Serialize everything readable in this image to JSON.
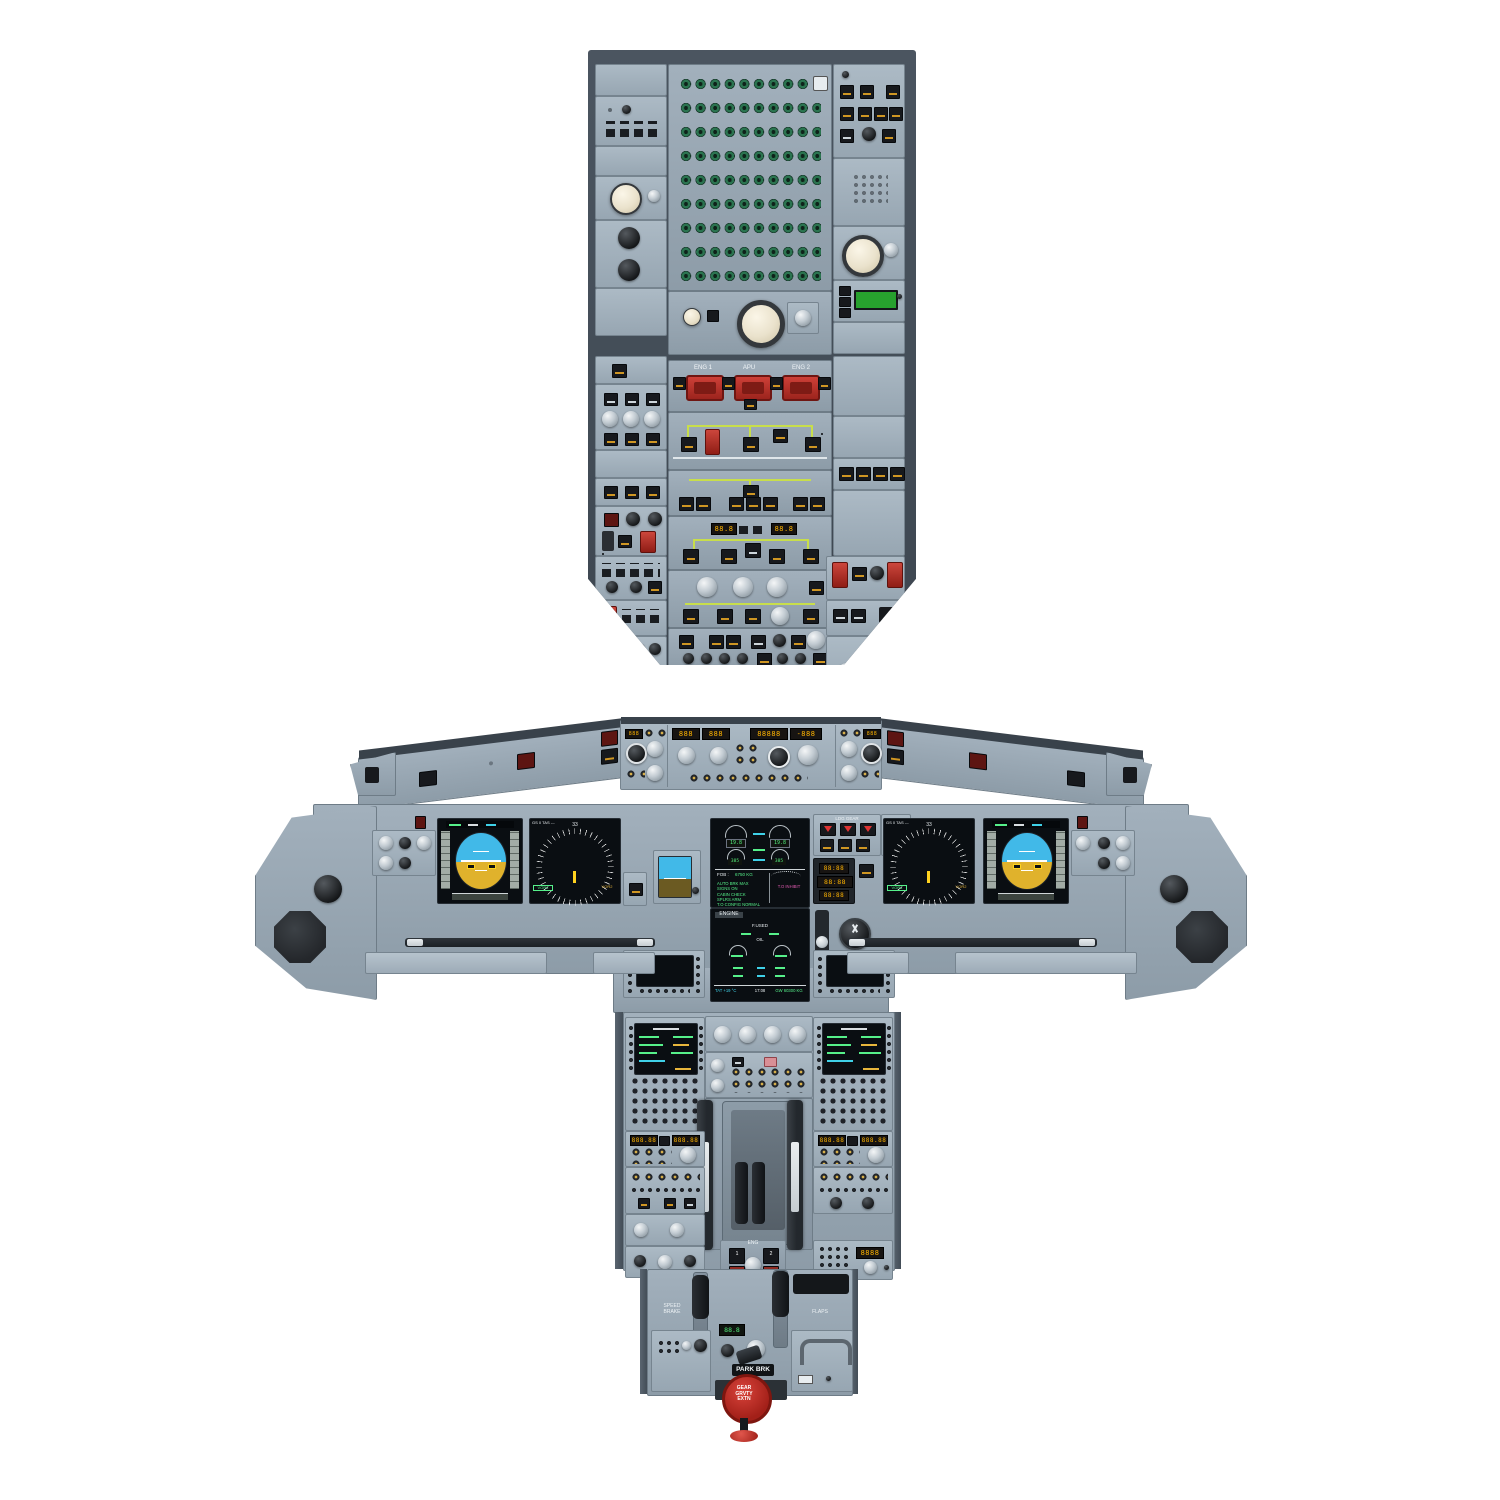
{
  "colors": {
    "panel_gray": "#9fadb9",
    "frame_dark": "#434c55",
    "screen_black": "#0a0e12",
    "crt_green": "#53ef7d",
    "amber": "#ffb400",
    "fire_red": "#b8241d",
    "sky_blue": "#41b9e8",
    "ground_tan": "#e0b22c",
    "diagram_green": "#c8de4b"
  },
  "overhead": {
    "fire_panel": {
      "eng1": "ENG 1",
      "apu": "APU",
      "eng2": "ENG 2"
    },
    "elec": {
      "bat1": "88.8",
      "bat2": "88.8"
    }
  },
  "glareshield": {
    "fcu": {
      "spd": "888",
      "hdg": "888",
      "alt": "88888",
      "vs": "-888"
    }
  },
  "main_panel": {
    "nd": {
      "gs": "GS 0 TAS ---",
      "hdg": "33",
      "vor1": "VOR1",
      "vor2": "VOR2"
    },
    "gear_panel": {
      "title": "LDG GEAR",
      "auto_brk": "AUTO BRK",
      "lo": "LO",
      "med": "MED",
      "max": "MAX"
    },
    "clock": {
      "chr": "88:88",
      "utc": "88:88",
      "et": "88:88"
    },
    "ecam_upper": {
      "n1_left": "19.8",
      "n1_right": "19.8",
      "egt_left": "385",
      "egt_right": "385",
      "fob_label": "FOB :",
      "fob_value": "6750 KG",
      "memo": [
        "AUTO BRK MAX",
        "SIGNS ON",
        "CABIN CHECK",
        "SPLRS ARM",
        "T.O CONFIG NORMAL"
      ],
      "inhibit": "T.O INHIBIT"
    },
    "ecam_lower": {
      "title": "ENGINE",
      "fused_label": "F.USED",
      "oil_label": "OIL",
      "tat": "TAT +19 °C",
      "time": "17:08",
      "gw": "GW 60300 KG"
    }
  },
  "pedestal": {
    "eng": {
      "panel": "ENG",
      "m1": "1",
      "m2": "2"
    },
    "speed_brake": "SPEED\nBRAKE",
    "flaps": "FLAPS",
    "park_brk": "PARK BRK",
    "gear_extn": "GEAR\nGRVTY\nEXTN",
    "atc_display": "8888",
    "rmp1": {
      "active": "888.88",
      "stby": "888.88"
    },
    "rmp2": {
      "active": "888.88",
      "stby": "888.88"
    },
    "rud_trim": "88.8"
  }
}
